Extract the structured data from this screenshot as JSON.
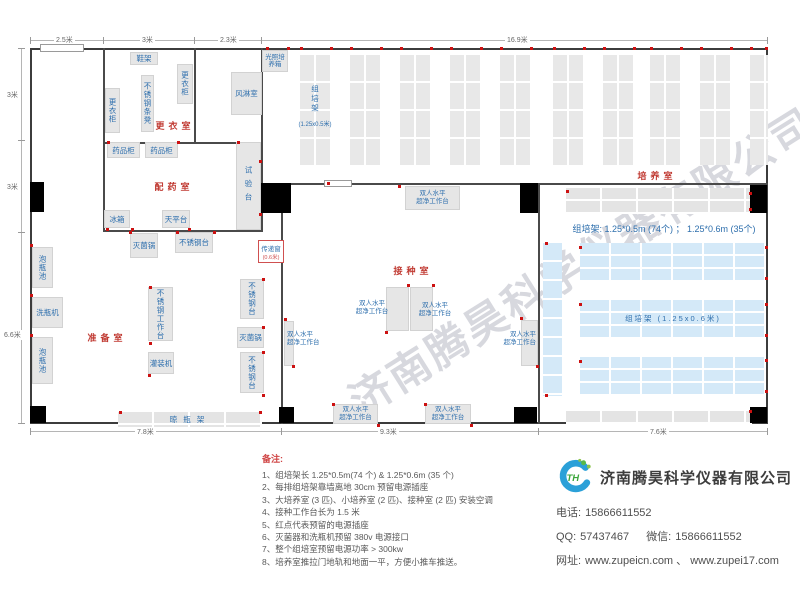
{
  "plan": {
    "dims": {
      "top": [
        "2.5米",
        "3米",
        "2.3米",
        "16.9米"
      ],
      "left": [
        "3米",
        "3米",
        "6.6米"
      ],
      "bottom": [
        "7.8米",
        "9.3米",
        "7.6米"
      ]
    },
    "rooms": {
      "changing": "更衣室",
      "air_shower": "风淋室",
      "pharmacy": "配药室",
      "prep": "准备室",
      "inoculation": "接种室",
      "culture": "培养室"
    },
    "equipment": {
      "shoe_rack": "鞋架",
      "locker": "更衣柜",
      "ss_bench": "不锈钢条凳",
      "light_incubator": "光照培养箱",
      "med_cabinet": "药品柜",
      "fridge": "冰箱",
      "balance_table": "天平台",
      "test_bench": "试验台",
      "soak_pool": "泡瓶池",
      "bottle_washer": "洗瓶机",
      "sterilizer": "灭菌锅",
      "ss_table": "不锈钢台",
      "ss_worktable": "不锈钢工作台",
      "filling_machine": "灌装机",
      "drying_rack": "晾瓶架",
      "pass_window": "传递窗",
      "pass_window_size": "(0.6米)",
      "clean_bench_l1": "双人水平",
      "clean_bench_l2": "超净工作台",
      "rack_label": "组培架",
      "rack_size_small": "(1.25x0.5米)",
      "rack_h_label": "组培架 (1.25x0.6米)"
    },
    "culture_summary": "组培架: 1.25*0.5m (74个) ； 1.25*0.6m (35个)"
  },
  "watermark": "济南腾昊科学仪器有限公司",
  "notes": {
    "title": "备注:",
    "items": [
      "1、组培架长 1.25*0.5m(74 个) & 1.25*0.6m (35 个)",
      "2、每排组培架靠墙离地 30cm 预留电源插座",
      "3、大培养室 (3 匹)、小培养室 (2 匹)、接种室 (2 匹) 安装空调",
      "4、接种工作台长为 1.5 米",
      "5、红点代表预留的电源插座",
      "6、灭菌器和洗瓶机预留 380v 电源接口",
      "7、整个组培室预留电源功率 > 300kw",
      "8、培养室推拉门地轨和地面一平，方便小推车推送。"
    ]
  },
  "company": {
    "name": "济南腾昊科学仪器有限公司",
    "logo_text": "TH",
    "phone_label": "电话:",
    "phone": "15866611552",
    "qq_label": "QQ:",
    "qq": "57437467",
    "wechat_label": "微信:",
    "wechat": "15866611552",
    "site_label": "网址:",
    "site": "www.zupeicn.com 、 www.zupei17.com"
  }
}
